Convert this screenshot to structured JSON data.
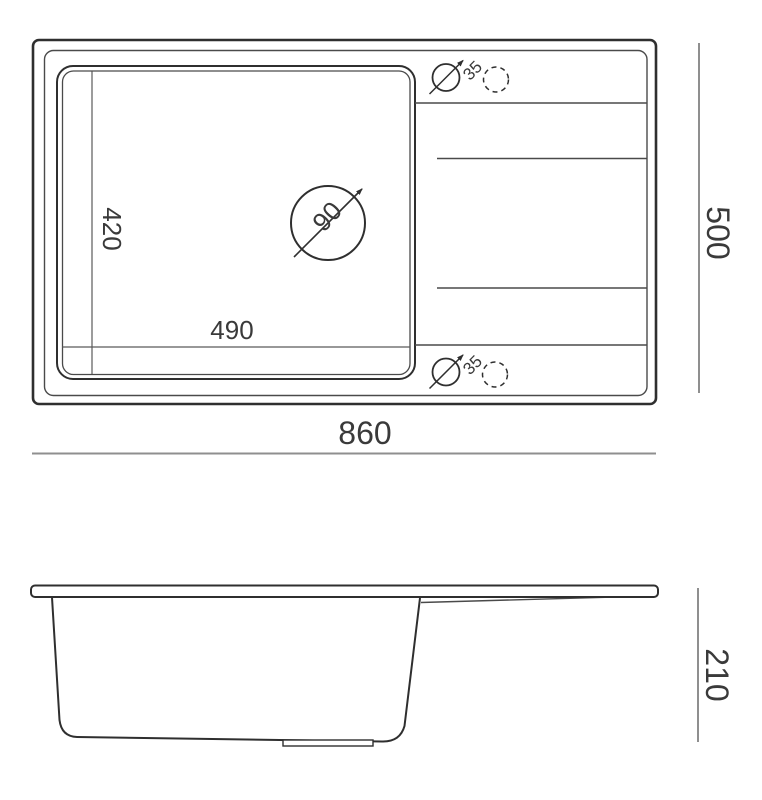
{
  "colors": {
    "outline": "#2f2f2f",
    "thin_line": "#4a4a4a",
    "dimension_line": "#8f8f8f",
    "text": "#3a3a3a",
    "background": "#ffffff"
  },
  "top_view": {
    "dimensions": {
      "overall_width": "860",
      "overall_depth": "500",
      "bowl_width": "490",
      "bowl_depth": "420",
      "drain_diameter": "90",
      "hole_top_diameter": "35",
      "hole_bottom_diameter": "35"
    }
  },
  "side_view": {
    "dimensions": {
      "overall_height": "210"
    }
  }
}
